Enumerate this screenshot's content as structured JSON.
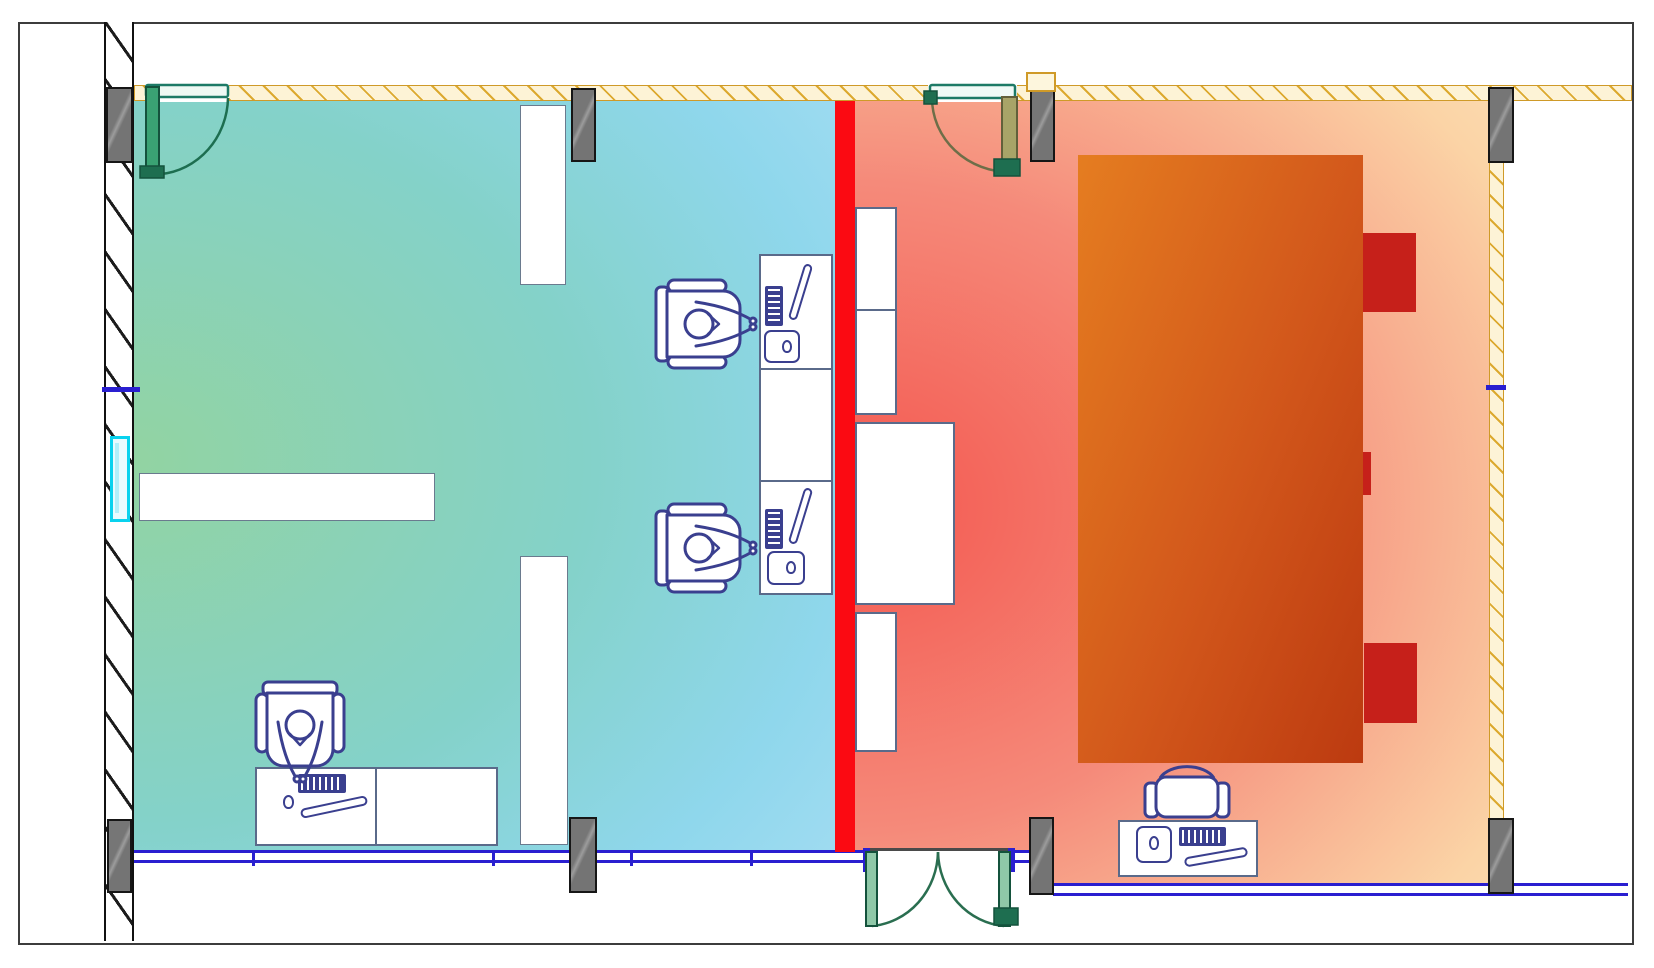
{
  "document": {
    "kind": "architectural floor plan with thermal zone overlay",
    "text_content": "none (drawing only, no visible text or numbers)"
  },
  "plan": {
    "separator": "red vertical barrier between the two rooms",
    "left_room": {
      "thermal_palette": "cool gradient, green at left wall to light blue at barrier",
      "furniture": [
        "double workstation desk block with 2 seated occupants and monitors/keyboards/mousepads",
        "corner desk at bottom-left with 1 seated occupant",
        "long wall shelf",
        "2 white partition strips",
        "cyan window on left wall"
      ],
      "doors": [
        "single swing door at top-left"
      ]
    },
    "right_room": {
      "thermal_palette": "warm gradient, red at barrier to pale orange at right wall",
      "furniture": [
        "large orange conference table",
        "3 red chairs on right side of table",
        "4 white side desks against barrier",
        "workstation desk with empty chair at bottom"
      ],
      "doors": [
        "single swing door at top",
        "double swing door at bottom"
      ]
    },
    "columns_count": 8,
    "walls": {
      "top_and_right": "yellow hatched partition wall",
      "left": "black diagonal-hatched structural wall",
      "bottom": "blue double-line curtain wall"
    }
  },
  "colors": {
    "frame_border": "#3c3c3c",
    "left_room_a": "#92d3a2",
    "left_room_c": "#a9def4",
    "right_room_a": "#f4574f",
    "right_room_c": "#fcdfb8",
    "barrier": "#fb0a12",
    "table_a": "#e57d20",
    "table_b": "#bc3a10",
    "chair_red": "#c6201a",
    "wall_yellow_fill": "#fdf3d6",
    "wall_yellow_border": "#cf9a28",
    "wall_yellow_hatch": "#dca92f",
    "wall_blue": "#2a1fd0",
    "hatch_black": "#1c1c1c",
    "column_fill": "#7d7d7d",
    "column_border": "#161616",
    "desk_border": "#5a6a8a",
    "furniture_ink": "#3a3f8f",
    "door_teal": "#1d7a66",
    "door_leaf_green": "#3aa273",
    "door_dark_green": "#1e6e50",
    "door_olive": "#a8a468",
    "window_cyan": "#09d2ee",
    "threshold": "#4a4a4a"
  }
}
